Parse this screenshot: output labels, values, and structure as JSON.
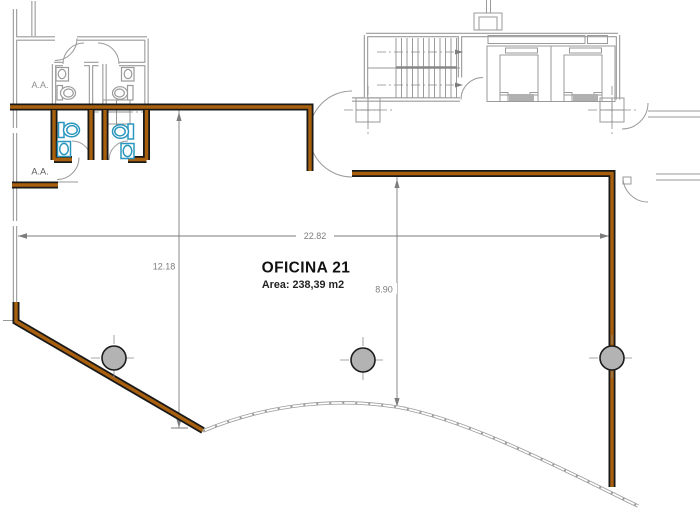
{
  "drawing": {
    "room": {
      "name": "OFICINA 21",
      "area_label": "Area: 238,39 m2"
    },
    "dimensions": [
      {
        "id": "overall-width",
        "value": "22.82"
      },
      {
        "id": "left-depth",
        "value": "12.18"
      },
      {
        "id": "right-depth",
        "value": "8.90"
      }
    ],
    "annotations": [
      {
        "id": "aa-upper",
        "text": "A.A."
      },
      {
        "id": "aa-lower",
        "text": "A.A."
      }
    ]
  },
  "colors": {
    "wall_fill": "#A8600F",
    "wall_edge": "#191919",
    "fixture": "#2B97BE",
    "structure_gray": "#9A9A9A",
    "column_fill": "#B3B3B3",
    "dim_gray": "#7D7D7D",
    "text_dark": "#111111"
  }
}
